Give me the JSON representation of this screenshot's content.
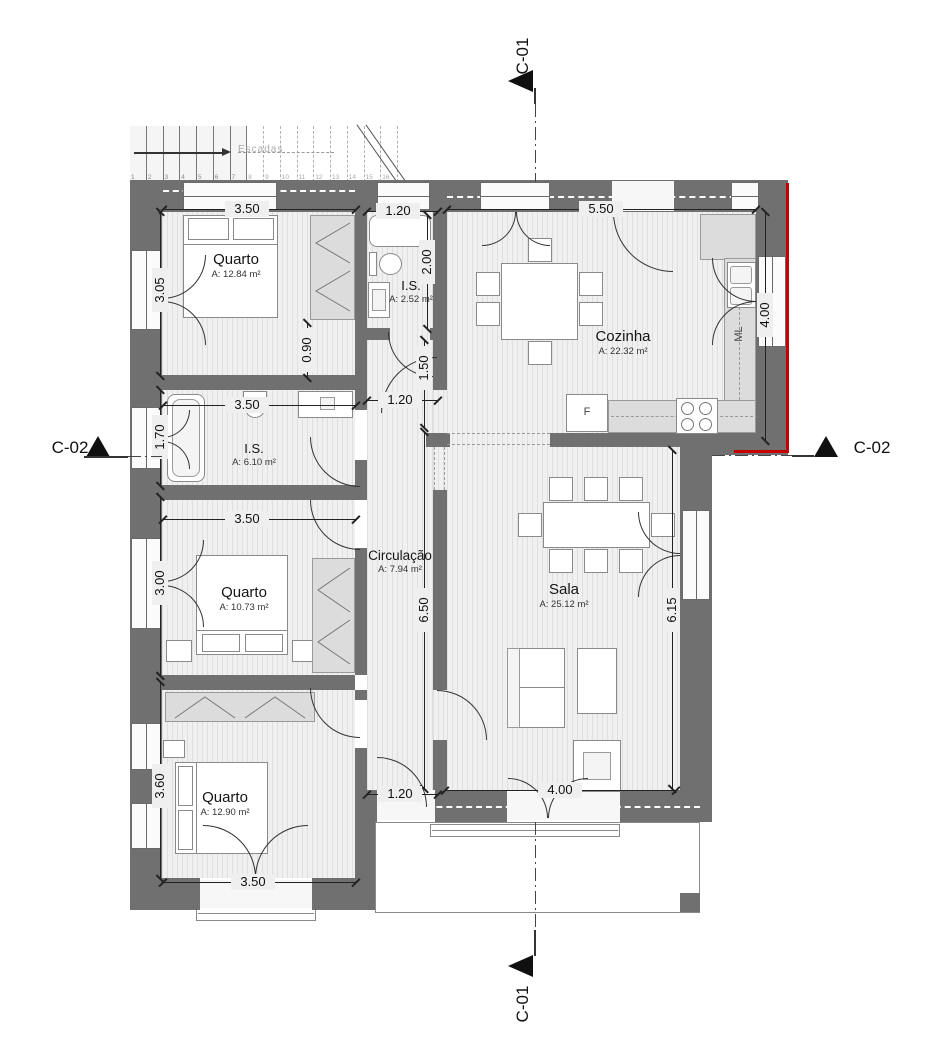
{
  "plan": {
    "sections": {
      "c01_top": "C-01",
      "c01_bottom": "C-01",
      "c02_left": "C-02",
      "c02_right": "C-02"
    },
    "stairs": {
      "label": "Escadas",
      "steps": [
        "1",
        "2",
        "3",
        "4",
        "5",
        "6",
        "7",
        "8",
        "9",
        "10",
        "11",
        "12",
        "13",
        "14",
        "15",
        "16"
      ]
    },
    "rooms": [
      {
        "name": "Quarto",
        "area": "A: 12.84 m²"
      },
      {
        "name": "I.S.",
        "area": "A: 2.52 m²"
      },
      {
        "name": "Cozinha",
        "area": "A: 22.32 m²"
      },
      {
        "name": "I.S.",
        "area": "A: 6.10 m²"
      },
      {
        "name": "Quarto",
        "area": "A: 10.73 m²"
      },
      {
        "name": "Circulação",
        "area": "A: 7.94 m²"
      },
      {
        "name": "Sala",
        "area": "A: 25.12 m²"
      },
      {
        "name": "Quarto",
        "area": "A: 12.90 m²"
      }
    ],
    "appliances": {
      "fridge": "F",
      "washer": "ML"
    },
    "dims": [
      "3.50",
      "1.20",
      "5.50",
      "2.00",
      "3.05",
      "4.00",
      "0.90",
      "1.50",
      "3.50",
      "1.20",
      "1.70",
      "3.50",
      "3.00",
      "6.50",
      "6.15",
      "3.60",
      "1.20",
      "4.00",
      "3.50"
    ],
    "colors": {
      "wall": "#707070",
      "section_cut": "#c40000",
      "floor": "#f0f0f0"
    }
  }
}
